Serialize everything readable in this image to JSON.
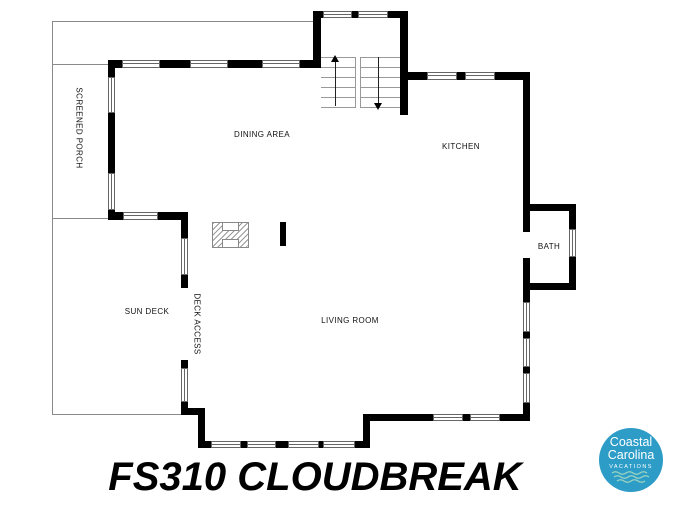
{
  "title": "FS310 CLOUDBREAK",
  "floor_plan": {
    "rooms": {
      "screened_porch": "SCREENED PORCH",
      "dining_area": "DINING AREA",
      "kitchen": "KITCHEN",
      "bath": "BATH",
      "sun_deck": "SUN DECK",
      "deck_access": "DECK ACCESS",
      "living_room": "LIVING ROOM"
    }
  },
  "logo": {
    "line1": "Coastal",
    "line2": "Carolina",
    "line3": "VACATIONS",
    "circle_color": "#2D9DC8",
    "wave_color": "#9FD6C0"
  },
  "colors": {
    "wall": "#000000",
    "thin_line": "#8a8a8a"
  }
}
